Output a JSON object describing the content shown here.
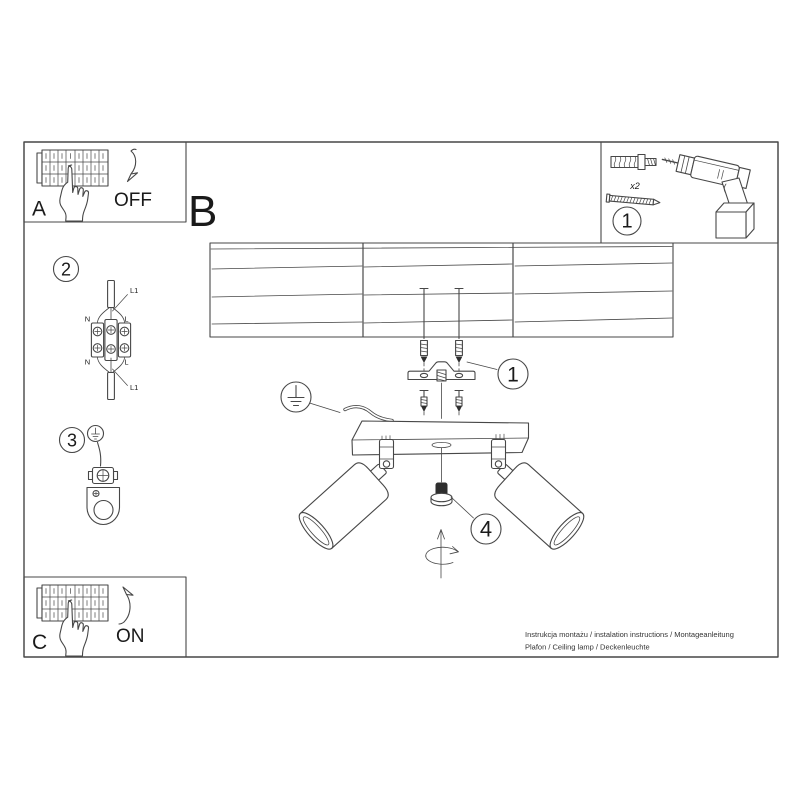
{
  "labels": {
    "step_a_letter": "A",
    "step_a_state": "OFF",
    "section_letter": "B",
    "step_c_letter": "C",
    "step_c_state": "ON"
  },
  "callouts": {
    "tools_number": "1",
    "mounting_number": "1",
    "wiring_number": "2",
    "grounding_number": "3",
    "adjust_number": "4"
  },
  "tools": {
    "dowel_quantity": "x2"
  },
  "wiring_labels": {
    "cable_top": "L1",
    "neutral_top": "N",
    "live_top": "L",
    "neutral_bottom": "N",
    "live_bottom": "L",
    "cable_bottom": "L1"
  },
  "footer": {
    "line1": "Instrukcja montażu / instalation instructions / Montageanleitung",
    "line2": "Plafon / Ceiling lamp / Deckenleuchte"
  },
  "colors": {
    "line": "#474747",
    "text": "#1a1a1a",
    "background": "#ffffff"
  }
}
